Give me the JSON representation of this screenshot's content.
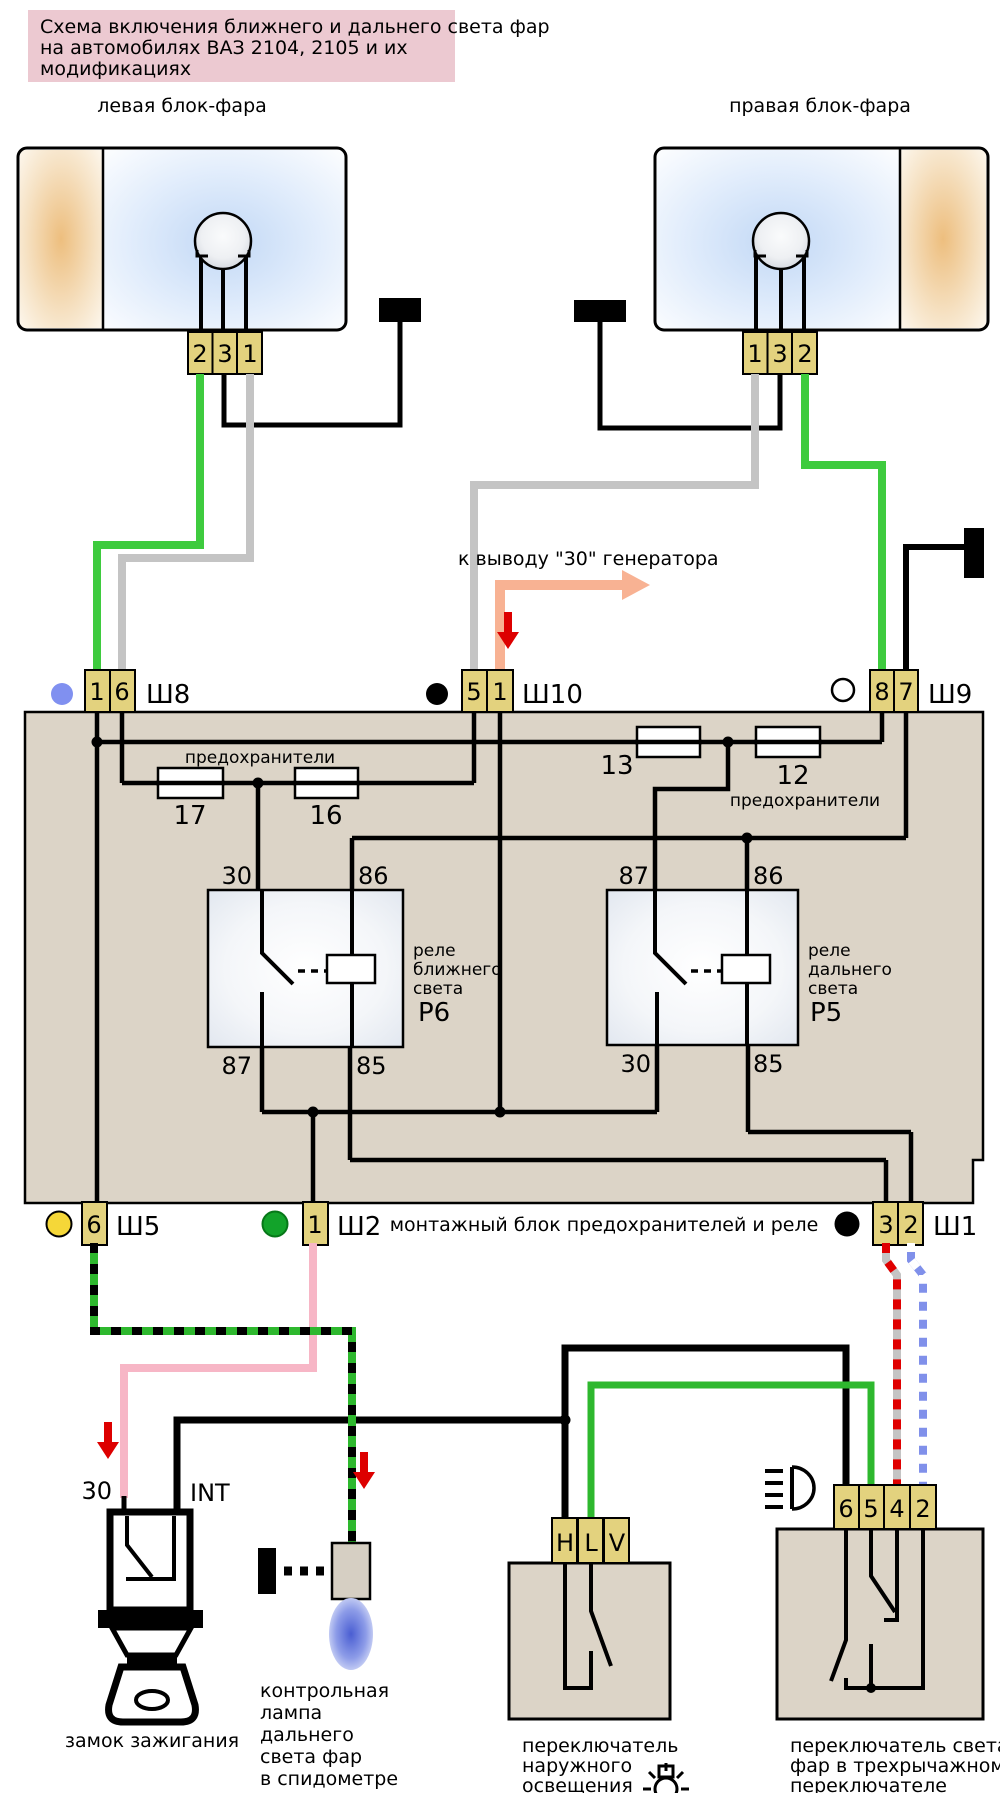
{
  "title": {
    "lines": [
      "Схема включения ближнего и дальнего света фар",
      "на автомобилях ВАЗ 2104, 2105 и их",
      "модификациях"
    ]
  },
  "headlights": {
    "left": {
      "label": "левая блок-фара",
      "pins": [
        "2",
        "3",
        "1"
      ]
    },
    "right": {
      "label": "правая блок-фара",
      "pins": [
        "1",
        "3",
        "2"
      ]
    }
  },
  "generator_note": "к выводу \"30\" генератора",
  "connectors": {
    "sh8": {
      "label": "Ш8",
      "pins": [
        "1",
        "6"
      ]
    },
    "sh10": {
      "label": "Ш10",
      "pins": [
        "5",
        "1"
      ]
    },
    "sh9": {
      "label": "Ш9",
      "pins": [
        "8",
        "7"
      ]
    },
    "sh5": {
      "label": "Ш5",
      "pins": [
        "6"
      ]
    },
    "sh2": {
      "label": "Ш2",
      "pins": [
        "1"
      ]
    },
    "sh1": {
      "label": "Ш1",
      "pins": [
        "3",
        "2"
      ]
    }
  },
  "fuses": {
    "f17": "17",
    "f16": "16",
    "f13": "13",
    "f12": "12",
    "left_group_label": "предохранители",
    "right_group_label": "предохранители"
  },
  "relays": {
    "p6": {
      "name": "Р6",
      "desc": [
        "реле",
        "ближнего",
        "света"
      ],
      "pin_tl": "30",
      "pin_tr": "86",
      "pin_bl": "87",
      "pin_br": "85"
    },
    "p5": {
      "name": "Р5",
      "desc": [
        "реле",
        "дальнего",
        "света"
      ],
      "pin_tl": "87",
      "pin_tr": "86",
      "pin_bl": "30",
      "pin_br": "85"
    }
  },
  "block_label": "монтажный блок предохранителей и реле",
  "ignition": {
    "terminal_30": "30",
    "terminal_int": "INT",
    "label": "замок зажигания"
  },
  "indicator_lamp": {
    "lines": [
      "контрольная",
      "лампа",
      "дальнего",
      "света фар",
      "в спидометре"
    ]
  },
  "light_switch": {
    "pins": [
      "H",
      "L",
      "V"
    ],
    "label_lines": [
      "переключатель",
      "наружного",
      "освещения"
    ]
  },
  "beam_switch": {
    "pins": [
      "6",
      "5",
      "4",
      "2"
    ],
    "label_lines": [
      "переключатель света",
      "фар в трехрычажном",
      "переключателе"
    ]
  },
  "colors": {
    "title_pink": "#ecc9d1",
    "block_beige": "#dcd4c7",
    "pin_tan": "#e3d27e",
    "wire_green": "#3ecb3e",
    "wire_gray": "#c4c4c4",
    "wire_pink": "#f7b6c6",
    "wire_salmon": "#f8b293",
    "wire_blue": "#8090ea",
    "dash_red": "#e00000",
    "arrow_red": "#dd0000",
    "marker_blue": "#8090f0",
    "marker_yellow": "#f5d738",
    "marker_green": "#12a32a",
    "lamp_blue": "#5568d8"
  }
}
